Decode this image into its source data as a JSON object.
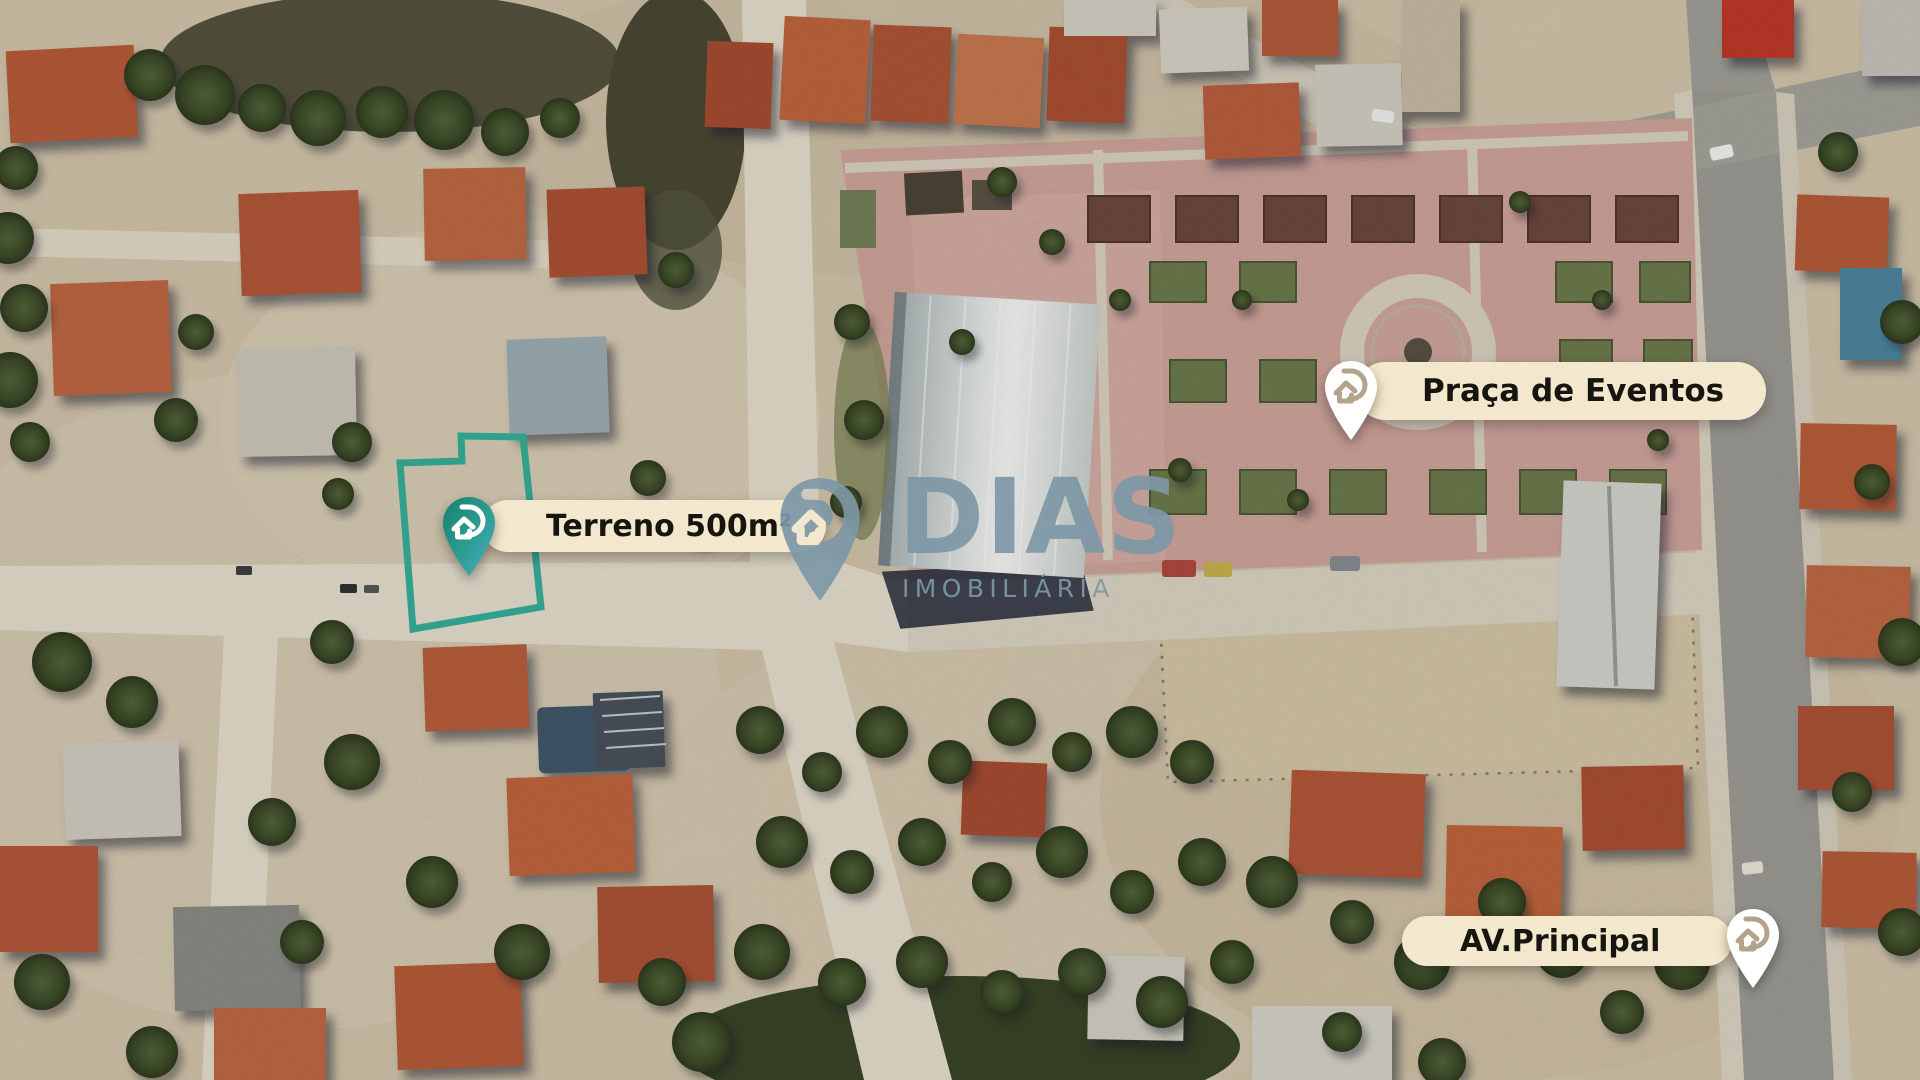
{
  "image_type": "real-estate aerial satellite map with location annotations",
  "markers": {
    "terreno": {
      "label": "Terreno 500m²",
      "pin": "teal-gradient-location-pin",
      "pin_side": "left",
      "outline_color": "#30a08d"
    },
    "praca": {
      "label": "Praça de Eventos",
      "pin": "white-location-pin",
      "pin_side": "left"
    },
    "avenida": {
      "label": "AV.Principal",
      "pin": "white-location-pin",
      "pin_side": "right"
    }
  },
  "watermark": {
    "brand": "DIAS",
    "tagline": "IMOBILIÁRIA"
  },
  "colors": {
    "accent_teal": "#30a08d",
    "pin_gradient_start": "#15806f",
    "pin_gradient_end": "#4aacc6",
    "label_background": "#f3e8cd",
    "label_text": "#17150f",
    "watermark_color": "#7d97a6",
    "sand": "#d8cbb0",
    "plaza_pavement": "#d1a69d",
    "roof_terracotta": "#b5583a",
    "asphalt": "#9e9d96"
  }
}
